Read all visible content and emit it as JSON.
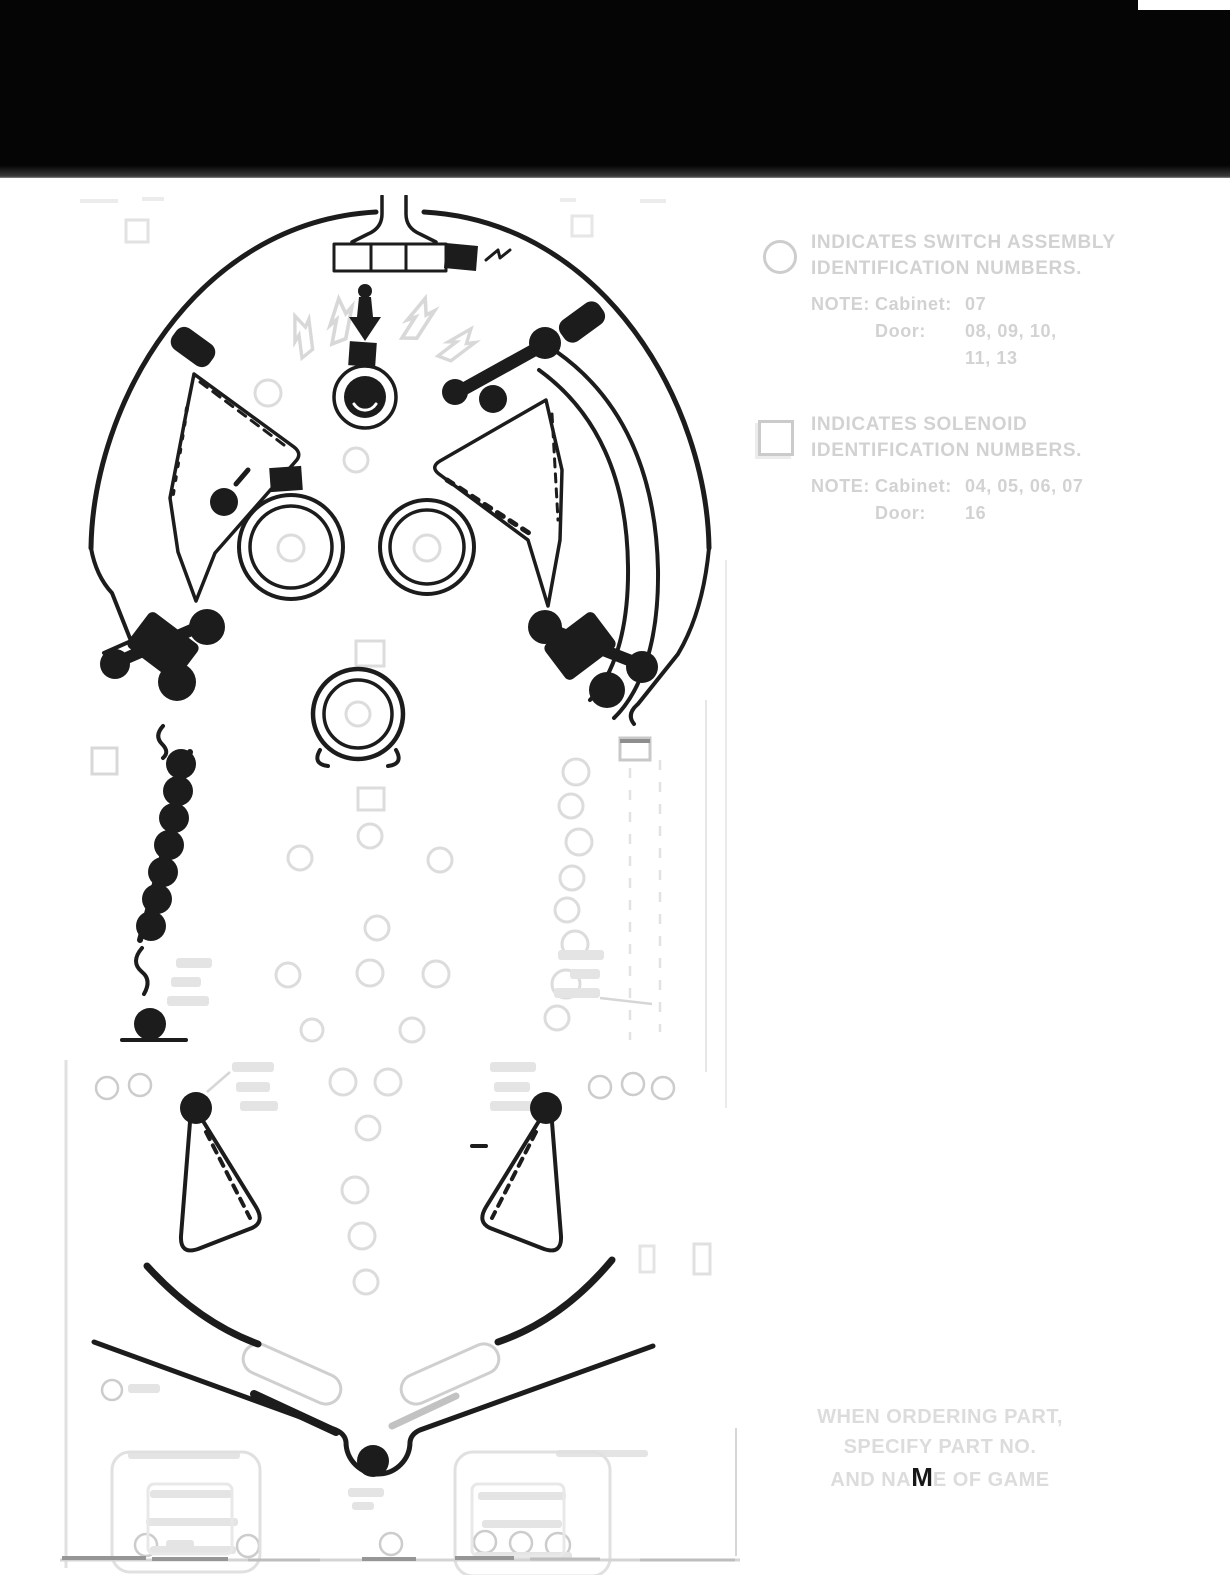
{
  "legend": {
    "switch": {
      "symbol": "circle",
      "line1": "INDICATES SWITCH ASSEMBLY",
      "line2": "IDENTIFICATION NUMBERS.",
      "note_label": "NOTE:",
      "cabinet_label": "Cabinet:",
      "cabinet_value": "07",
      "door_label": "Door:",
      "door_value_line1": "08, 09, 10,",
      "door_value_line2": "11, 13"
    },
    "solenoid": {
      "symbol": "square",
      "line1": "INDICATES SOLENOID",
      "line2": "IDENTIFICATION NUMBERS.",
      "note_label": "NOTE:",
      "cabinet_label": "Cabinet:",
      "cabinet_value": "04, 05, 06, 07",
      "door_label": "Door:",
      "door_value": "16"
    }
  },
  "footer_note": {
    "line1": "WHEN ORDERING PART,",
    "line2": "SPECIFY PART NO.",
    "line3_pre": "AND NA",
    "line3_highlight": "M",
    "line3_post": "E OF GAME"
  },
  "colors": {
    "ink": "#1c1c1c",
    "faint": "#dcdcdc",
    "legend_text": "#d2d2d2",
    "redaction_bar": "#050505",
    "paper": "#ffffff"
  }
}
